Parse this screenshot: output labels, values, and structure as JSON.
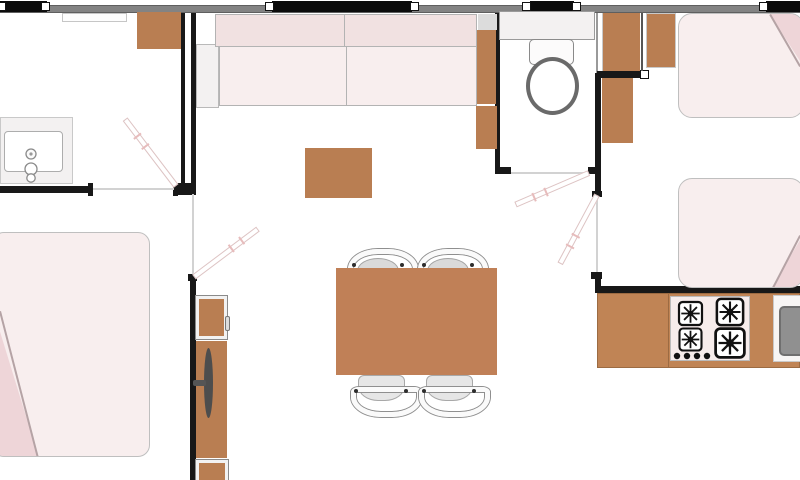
{
  "title": "Mobile home floor plan (top-down architectural diagram, no text labels)",
  "colors": {
    "floor": "#ffffff",
    "wall_band": "#838383",
    "wall_dark": "#181818",
    "window_bar": "#0b0b0b",
    "cap_white": "#ffffff",
    "wood": "#b97e52",
    "counter": "#c08455",
    "table": "#c08057",
    "fabric_light": "#f8eeee",
    "cushion": "#f1e1e1",
    "pillow": "#eed5d8",
    "fixture_light": "#f3f1f1",
    "steel": "#909090",
    "tv": "#4d4d4d",
    "door_leaf_border": "#ddc3c3",
    "threshold": "#d2d2d2",
    "outline": "#b3b3b3"
  },
  "rooms": [
    {
      "name": "dressing-room-top-left"
    },
    {
      "name": "master-bedroom-bottom-left"
    },
    {
      "name": "living-dining-area-center"
    },
    {
      "name": "toilet-room"
    },
    {
      "name": "twin-bedroom-right"
    },
    {
      "name": "kitchen-zone"
    }
  ],
  "windows": [
    {
      "name": "window-dressing-room"
    },
    {
      "name": "window-living-room"
    },
    {
      "name": "window-toilet"
    },
    {
      "name": "window-twin-bedroom"
    }
  ],
  "doors": [
    {
      "name": "door-dressing-room"
    },
    {
      "name": "door-master-bedroom"
    },
    {
      "name": "door-toilet"
    },
    {
      "name": "door-twin-bedroom"
    }
  ],
  "furniture": [
    {
      "name": "wardrobe-top-left"
    },
    {
      "name": "vanity-with-sink"
    },
    {
      "name": "sofa-two-seat"
    },
    {
      "name": "side-cabinets-right-of-sofa"
    },
    {
      "name": "coffee-table"
    },
    {
      "name": "dining-table"
    },
    {
      "name": "dining-chairs",
      "count": 4
    },
    {
      "name": "fridge-unit"
    },
    {
      "name": "tv-cabinet-with-tv"
    },
    {
      "name": "storage-unit-bottom"
    },
    {
      "name": "master-double-bed-with-pillow"
    },
    {
      "name": "toilet-shelf"
    },
    {
      "name": "toilet-wc"
    },
    {
      "name": "wardrobe-columns-right",
      "count": 2
    },
    {
      "name": "bedside-cabinet"
    },
    {
      "name": "single-bed-top-with-pillow"
    },
    {
      "name": "single-bed-bottom-with-pillow"
    },
    {
      "name": "kitchen-counter"
    },
    {
      "name": "hob-4-burners"
    },
    {
      "name": "kitchen-sink"
    }
  ]
}
